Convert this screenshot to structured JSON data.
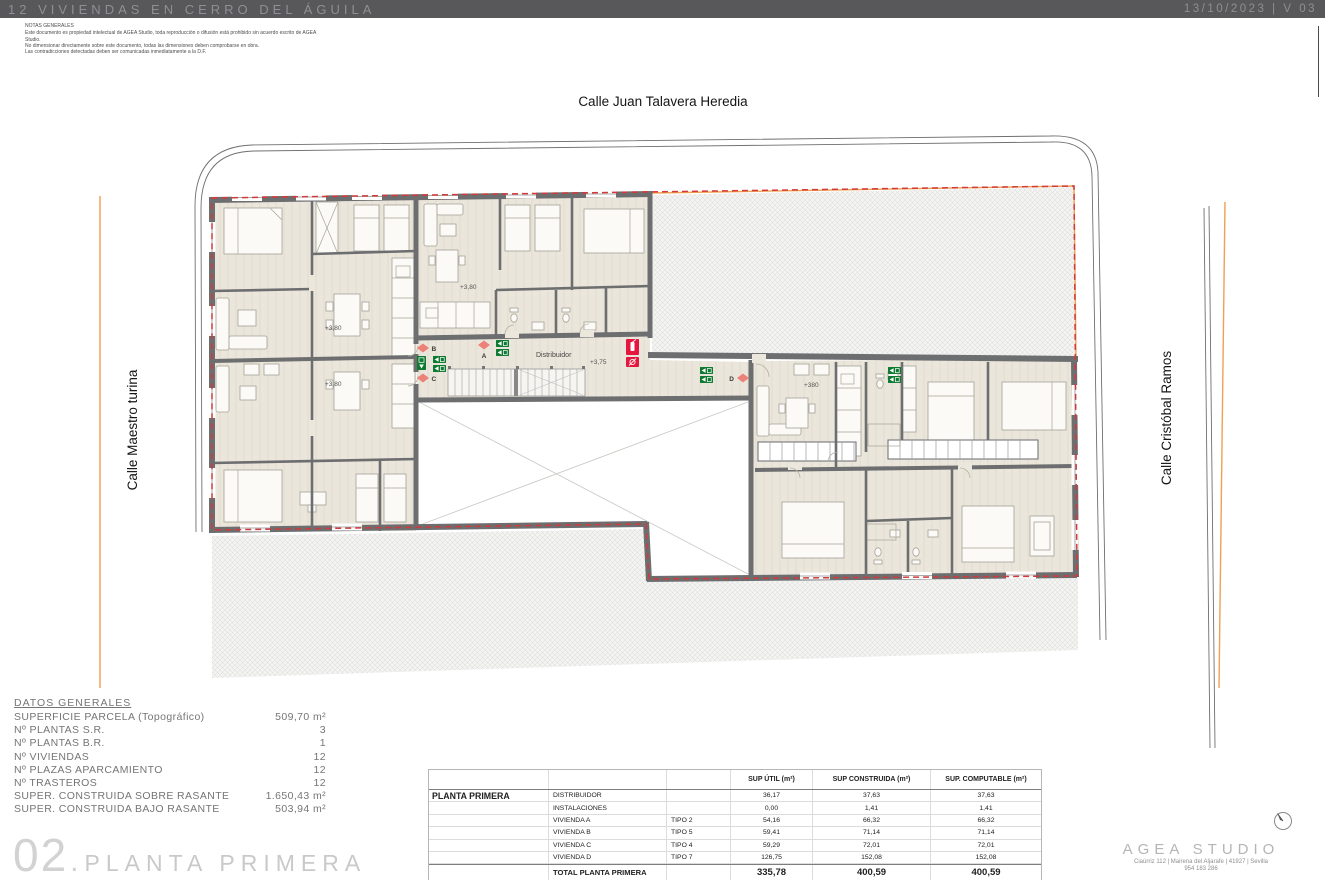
{
  "header": {
    "title": "12 VIVIENDAS EN CERRO DEL ÁGUILA",
    "date": "13/10/2023",
    "divider": "|",
    "version": "V 03"
  },
  "notes": {
    "title": "NOTAS GENERALES",
    "lines": [
      "Este documento es propiedad intelectual de AGEA Studio, toda reproducción o difusión está prohibido sin acuerdo escrito de AGEA",
      "Studio.",
      "No dimensionar directamente sobre este documento, todas las dimensiones deben comprobarse en obra.",
      "Las contradicciones detectadas deben ser comunicadas inmediatamente a la D.F."
    ]
  },
  "streets": {
    "top": "Calle Juan Talavera Heredia",
    "left": "Calle Maestro turina",
    "right": "Calle Cristóbal Ramos"
  },
  "plan": {
    "room_label": "Distribuidor",
    "levels": [
      "+3,80",
      "+3,80",
      "+3,80",
      "+3,75",
      "+380"
    ],
    "markers": [
      "B",
      "A",
      "C",
      "D"
    ]
  },
  "datos": {
    "title": "DATOS GENERALES",
    "rows": [
      {
        "label": "SUPERFICIE PARCELA (Topográfico)",
        "value": "509,70 m²"
      },
      {
        "label": "Nº PLANTAS S.R.",
        "value": "3"
      },
      {
        "label": "Nº PLANTAS B.R.",
        "value": "1"
      },
      {
        "label": "Nº VIVIENDAS",
        "value": "12"
      },
      {
        "label": "Nº PLAZAS APARCAMIENTO",
        "value": "12"
      },
      {
        "label": "Nº TRASTEROS",
        "value": "12"
      },
      {
        "label": "SUPER. CONSTRUIDA SOBRE RASANTE",
        "value": "1.650,43 m²"
      },
      {
        "label": "SUPER. CONSTRUIDA BAJO RASANTE",
        "value": "503,94 m²"
      }
    ]
  },
  "table": {
    "col_headers": [
      "SUP ÚTIL (m²)",
      "SUP CONSTRUIDA (m²)",
      "SUP. COMPUTABLE (m²)"
    ],
    "section_label": "PLANTA PRIMERA",
    "rows": [
      {
        "name": "DISTRIBUIDOR",
        "tipo": "",
        "util": "36,17",
        "con": "37,63",
        "com": "37,63"
      },
      {
        "name": "INSTALACIONES",
        "tipo": "",
        "util": "0,00",
        "con": "1,41",
        "com": "1,41"
      },
      {
        "name": "VIVIENDA A",
        "tipo": "TIPO 2",
        "util": "54,16",
        "con": "66,32",
        "com": "66,32"
      },
      {
        "name": "VIVIENDA B",
        "tipo": "TIPO 5",
        "util": "59,41",
        "con": "71,14",
        "com": "71,14"
      },
      {
        "name": "VIVIENDA C",
        "tipo": "TIPO 4",
        "util": "59,29",
        "con": "72,01",
        "com": "72,01"
      },
      {
        "name": "VIVIENDA D",
        "tipo": "TIPO 7",
        "util": "126,75",
        "con": "152,08",
        "com": "152,08"
      }
    ],
    "total": {
      "name": "TOTAL PLANTA PRIMERA",
      "util": "335,78",
      "con": "400,59",
      "com": "400,59"
    }
  },
  "sheet": {
    "number": "02",
    "separator": ".",
    "title": "PLANTA PRIMERA"
  },
  "studio": {
    "name": "AGEA STUDIO",
    "address": "Ciaúrriz 112 | Mairena del Aljarafe | 41927 | Sevilla",
    "phone": "954 183 286"
  },
  "colors": {
    "header_bar": "#58585a",
    "wall": "#6d6e70",
    "exit_green": "#0e7a31",
    "fire_red": "#e6173e",
    "marker_salmon": "#ec8178",
    "parcel_orange": "#f0a050",
    "boundary_red": "#d13a3a"
  }
}
